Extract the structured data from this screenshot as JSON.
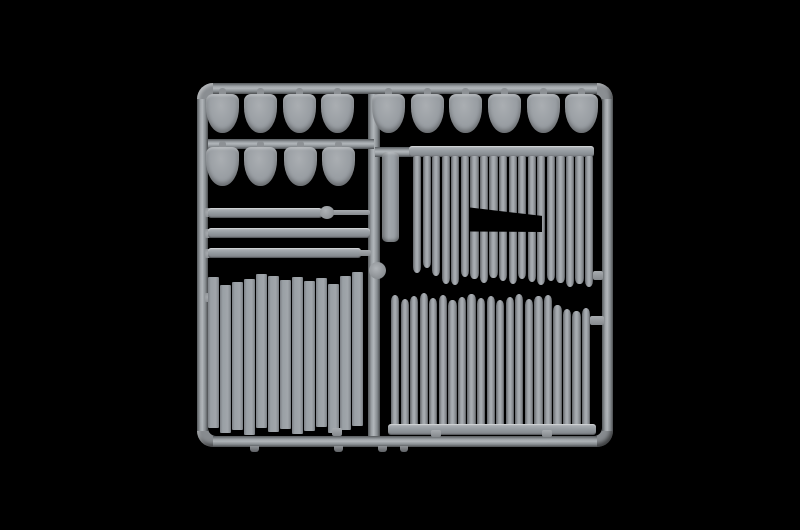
{
  "scene": {
    "subject": "plastic-model-kit-sprue",
    "background": "studio-black"
  },
  "colors": {
    "background": "#000000",
    "plastic_base": "#9ba0a5",
    "plastic_light": "#b1b6ba",
    "plastic_dark": "#55595c",
    "seam_shadow": "#44474a"
  },
  "sprue": {
    "frame": {
      "x": 197,
      "y": 83,
      "w": 416,
      "h": 364,
      "rail": 11,
      "radius": 16
    },
    "center_rail": {
      "x": 368,
      "w": 12
    },
    "mid_rail": {
      "x": 202,
      "y": 139,
      "w": 172,
      "h": 10
    },
    "junction": {
      "x": 375,
      "y": 147,
      "w": 37,
      "h": 10
    },
    "node": {
      "cx": 377,
      "cy": 270,
      "d": 17
    },
    "shields": {
      "w": 33,
      "h": 39,
      "rows": [
        {
          "name": "shields-top-left",
          "y": 94,
          "centers": [
            222,
            260,
            299,
            337
          ]
        },
        {
          "name": "shields-mid-left",
          "y": 147,
          "centers": [
            222,
            260,
            300,
            338
          ]
        },
        {
          "name": "shields-top-right",
          "y": 94,
          "centers": [
            388,
            427,
            465,
            504,
            543,
            581
          ]
        }
      ]
    },
    "strips": [
      {
        "x": 208,
        "y": 208,
        "w": 114,
        "h": 10,
        "knob": {
          "x": 320,
          "y": 206,
          "w": 14,
          "h": 13
        },
        "rod": {
          "x": 332,
          "y": 210,
          "w": 38,
          "h": 5
        }
      },
      {
        "x": 208,
        "y": 228,
        "w": 162,
        "h": 10
      },
      {
        "x": 208,
        "y": 248,
        "w": 153,
        "h": 10,
        "rod": {
          "x": 359,
          "y": 250,
          "w": 12,
          "h": 6
        }
      }
    ],
    "tall_plank": {
      "x": 382,
      "y": 152,
      "w": 17,
      "h": 90
    },
    "palisade_top": {
      "beam": {
        "x": 409,
        "y": 146,
        "w": 185,
        "h": 11
      },
      "log_x0": 413,
      "pitch": 9.55,
      "log_w": 8.3,
      "log_top": 156,
      "count": 19,
      "log_bottoms": [
        273,
        268,
        276,
        284,
        285,
        277,
        279,
        283,
        278,
        281,
        284,
        279,
        282,
        285,
        281,
        283,
        287,
        284,
        287
      ],
      "window": {
        "x": 470,
        "y": 206,
        "w": 72,
        "h": 26
      },
      "conn": {
        "x": 593,
        "y": 271,
        "w": 10,
        "h": 9
      }
    },
    "palisade_bottom": {
      "beam": {
        "x": 388,
        "y": 424,
        "w": 208,
        "h": 11
      },
      "log_x0": 391,
      "pitch": 9.55,
      "log_w": 8.3,
      "log_bottom": 426,
      "count": 21,
      "log_tops": [
        295,
        299,
        296,
        293,
        298,
        295,
        300,
        297,
        294,
        298,
        296,
        300,
        297,
        294,
        299,
        296,
        295,
        305,
        309,
        311,
        308
      ],
      "conn": {
        "x": 590,
        "y": 316,
        "w": 14,
        "h": 9
      },
      "nubs": [
        {
          "x": 431,
          "y": 430,
          "w": 10,
          "h": 7
        },
        {
          "x": 542,
          "y": 430,
          "w": 10,
          "h": 7
        }
      ]
    },
    "plank_wall": {
      "x0": 208,
      "pitch": 12.0,
      "plank_w": 11.2,
      "count": 13,
      "tops": [
        277,
        285,
        282,
        279,
        274,
        276,
        280,
        277,
        281,
        278,
        284,
        276,
        272
      ],
      "bottoms": [
        428,
        433,
        430,
        435,
        428,
        432,
        429,
        434,
        431,
        427,
        433,
        430,
        426
      ],
      "nub": {
        "x": 332,
        "y": 428,
        "w": 10,
        "h": 8
      }
    },
    "left_nubs": [
      212,
      233,
      253,
      297
    ],
    "tabs": [
      {
        "x": 250,
        "w": 9
      },
      {
        "x": 334,
        "w": 9
      },
      {
        "x": 378,
        "w": 9
      },
      {
        "x": 400,
        "w": 8
      }
    ]
  }
}
